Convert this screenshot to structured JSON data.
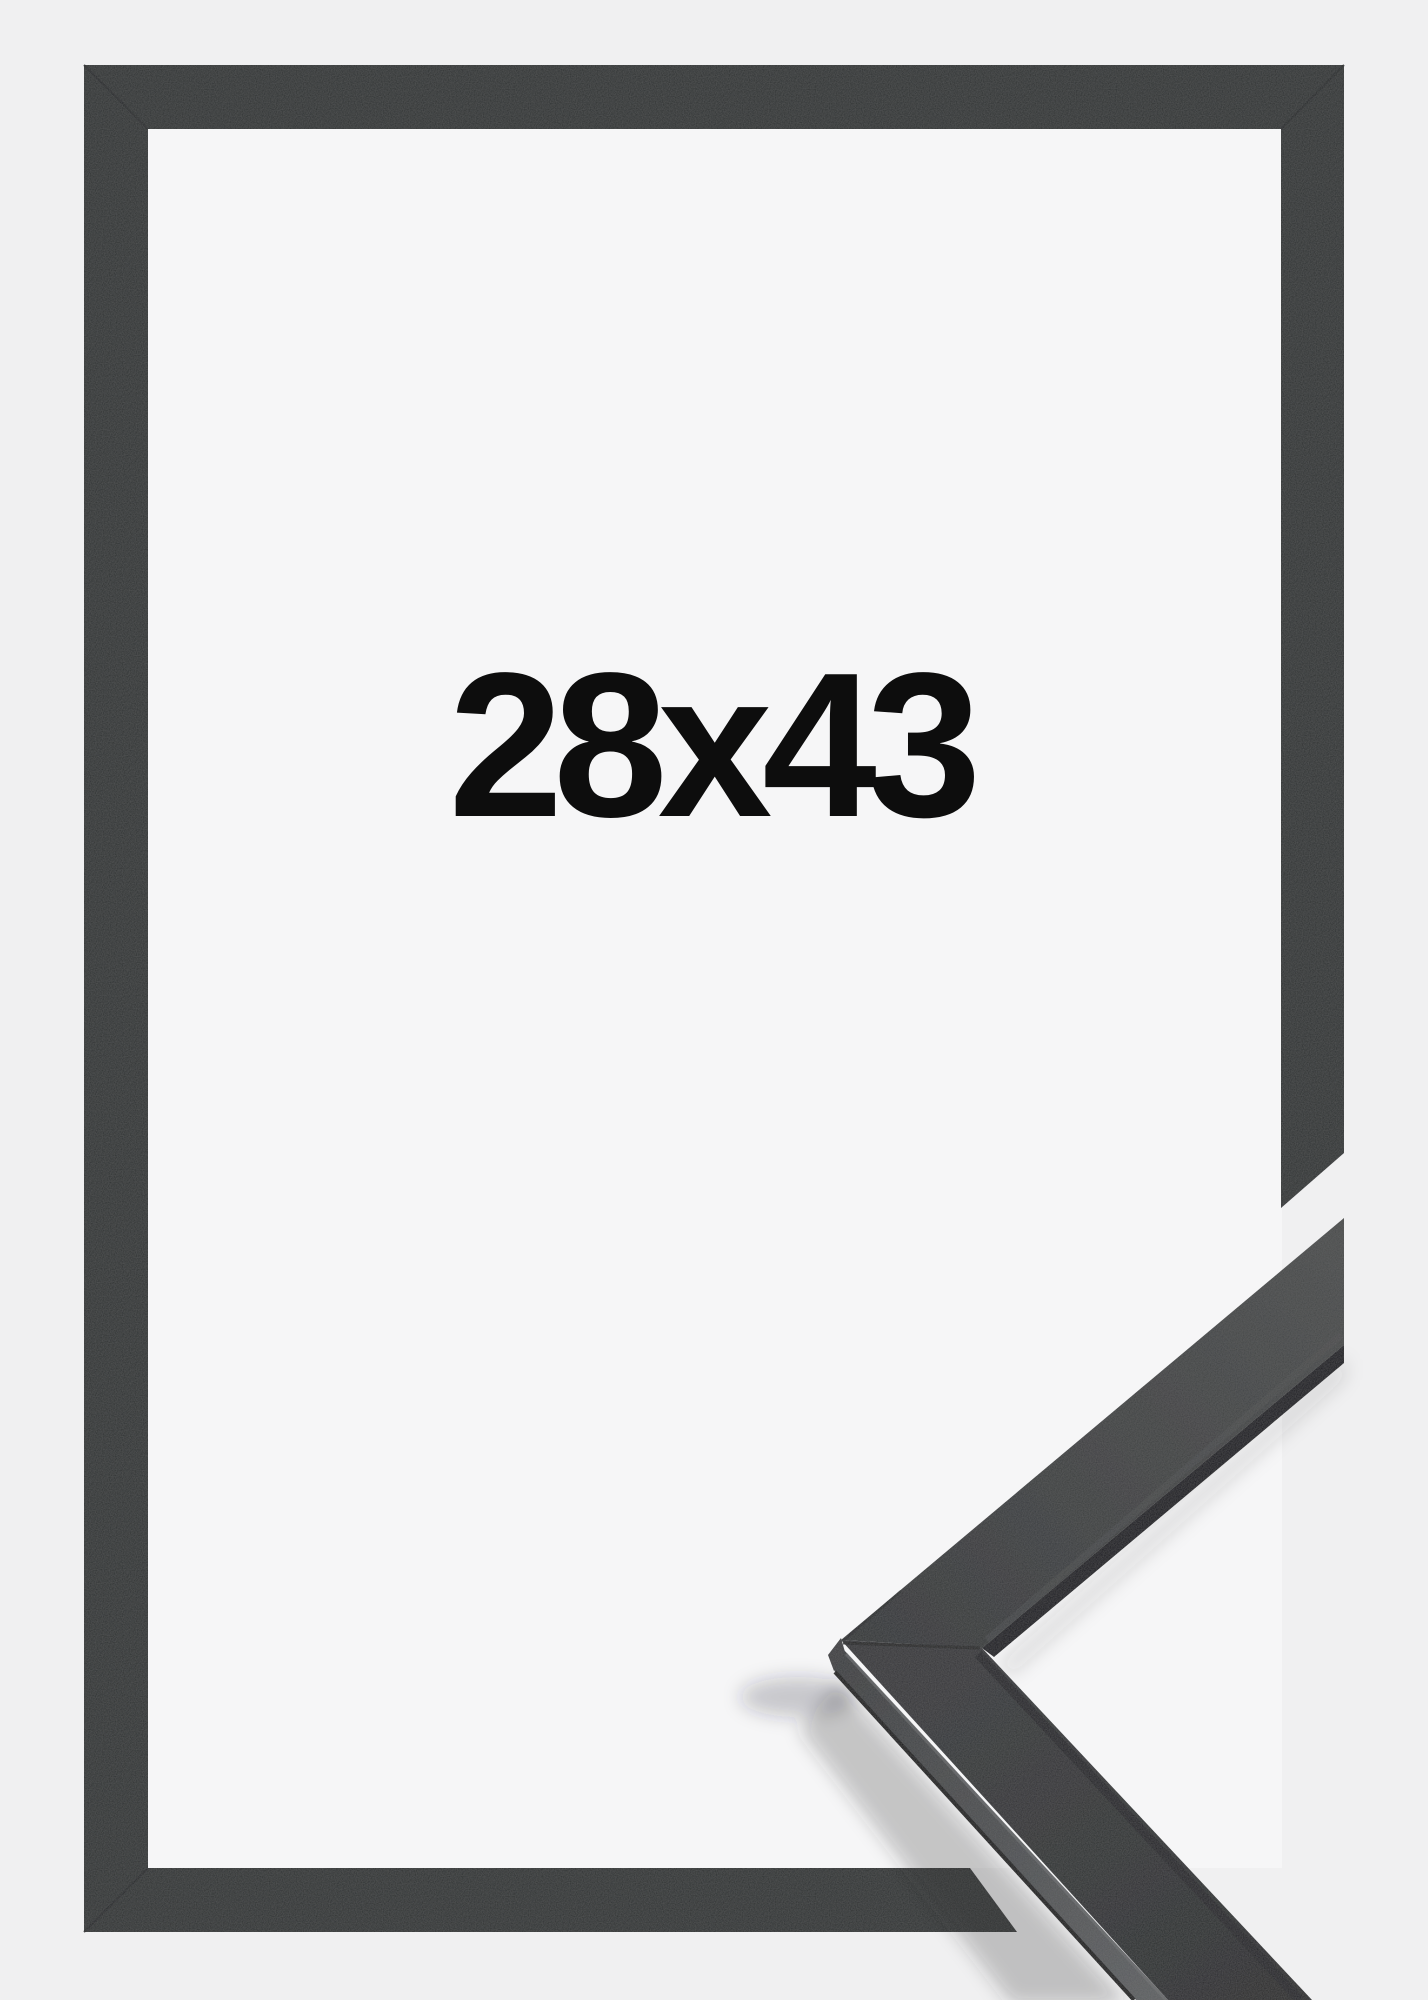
{
  "image": {
    "kind": "product-photo",
    "subject": "black picture frame with corner profile detail",
    "size_label": "28x43"
  },
  "colors": {
    "background": "#f0f0f1",
    "interior": "#f6f6f7",
    "frame": "#2f3133",
    "frame_seam": "#212325",
    "label_text": "#0d0d0d",
    "face_end": "#474949",
    "face_apex": "#323436",
    "lower_face_top": "#343638",
    "lower_face_bottom": "#292b2c",
    "side_near": "#3b3d3f",
    "side_far": "#5d5f61",
    "underside": "#17181a",
    "edge_dark": "#141517",
    "edge_band": "#202224",
    "bevel_light": "#4c4e4f",
    "arris_light": "#6f7173",
    "tip_face": "#3c3e40",
    "sample_seam": "#1c1e20",
    "shadow": "#2b2b30"
  }
}
